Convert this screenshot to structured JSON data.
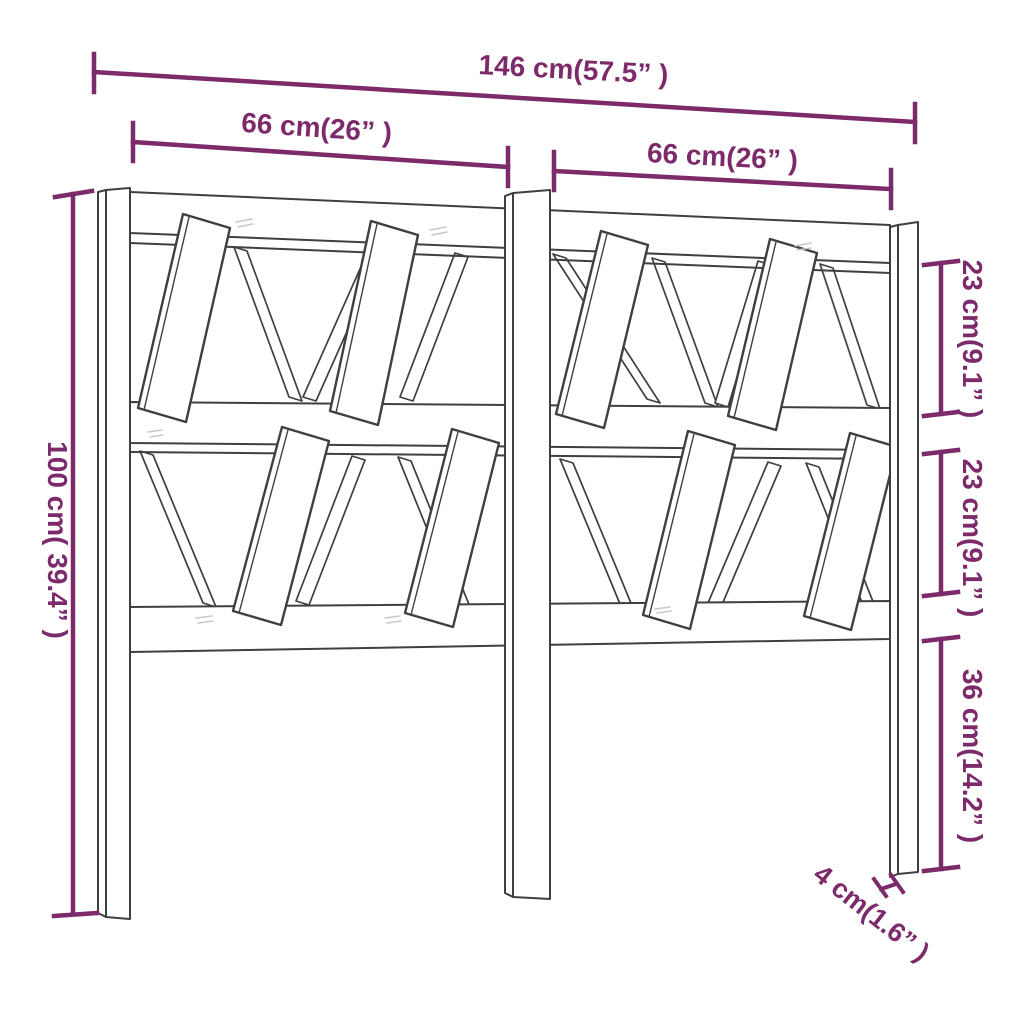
{
  "figure": {
    "type": "product-dimension-diagram",
    "subject": "wooden-headboard-with-angled-slats"
  },
  "colors": {
    "dimension_accent": "#7D2A6A",
    "drawing_outline": "#3F3F3F",
    "background": "#FFFFFF"
  },
  "dimension_labels": {
    "total_width": "146 cm(57.5” )",
    "left_section_width": "66 cm(26” )",
    "right_section_width": "66 cm(26” )",
    "total_height": "100 cm( 39.4” )",
    "upper_row_height": "23 cm(9.1” )",
    "lower_row_height": "23 cm(9.1” )",
    "leg_height": "36 cm(14.2” )",
    "post_thickness": "4 cm(1.6” )"
  }
}
